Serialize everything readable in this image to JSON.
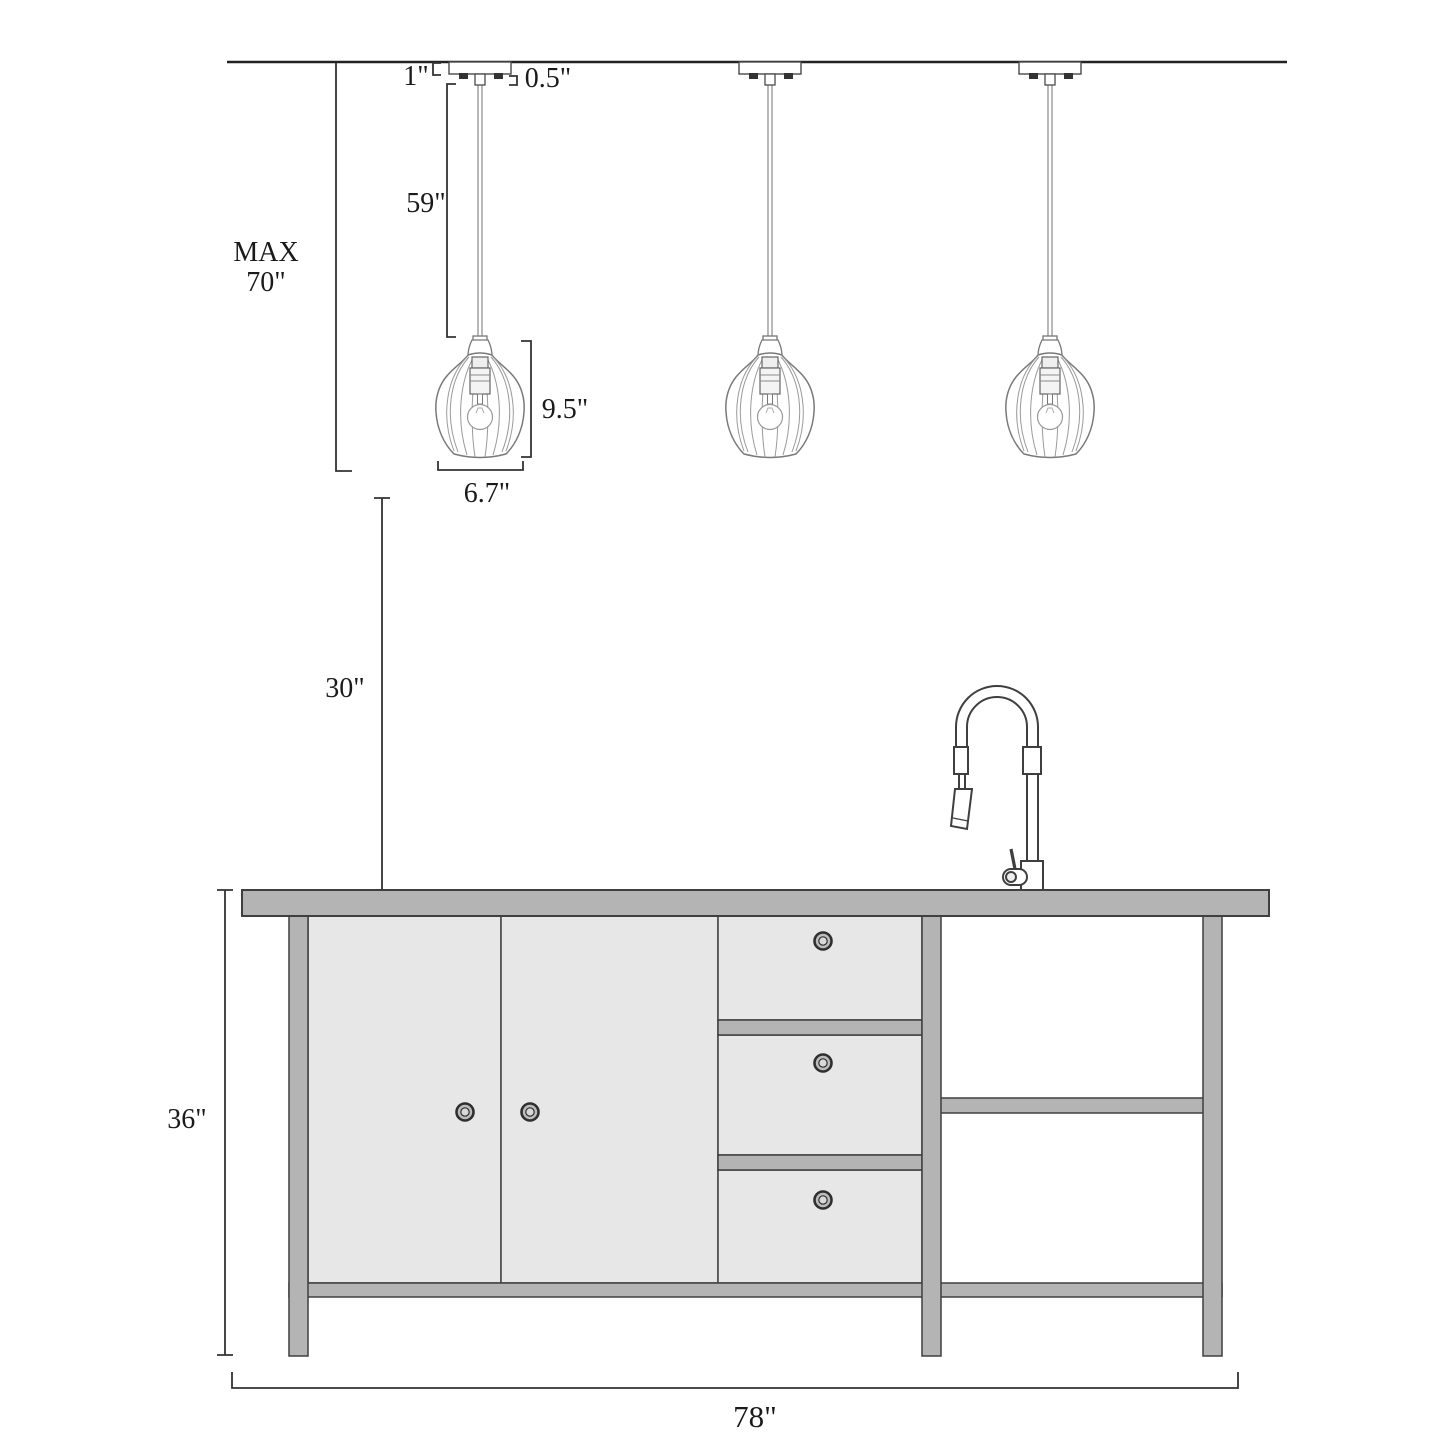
{
  "diagram": {
    "type": "product-dimension-drawing",
    "subject": "3-light pendant fixtures over kitchen island with faucet",
    "pendant_count": 3,
    "dimensions": {
      "canopy_height": "1\"",
      "stem_height": "0.5\"",
      "cord_length": "59\"",
      "max_height_line1": "MAX",
      "max_height_line2": "70\"",
      "shade_height": "9.5\"",
      "shade_width": "6.7\"",
      "hang_clearance": "30\"",
      "island_height": "36\"",
      "island_width": "78\""
    },
    "colors": {
      "background": "#ffffff",
      "frame_gray": "#b4b4b4",
      "panel_gray": "#e7e7e7",
      "outline_dark": "#3f3f3f",
      "glass_line": "#7a7a7a",
      "text": "#1a1a1a"
    }
  }
}
